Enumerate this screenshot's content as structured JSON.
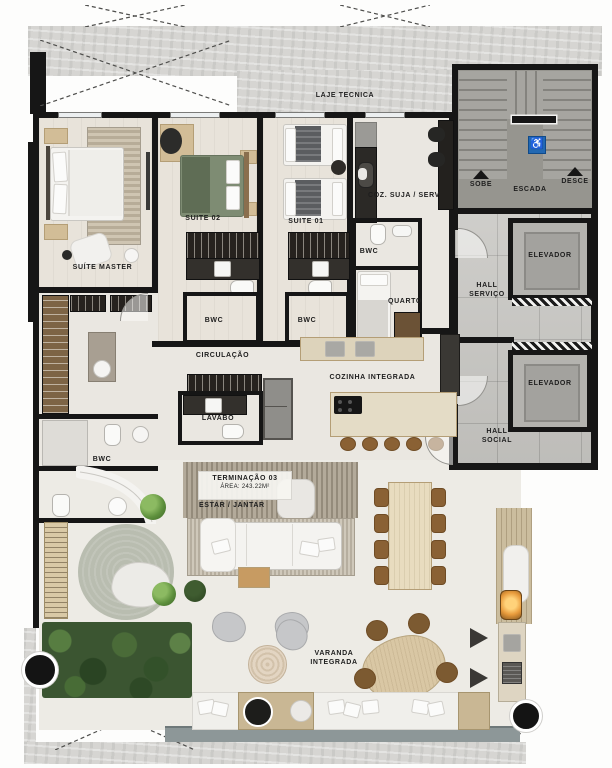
{
  "meta": {
    "title_block": {
      "unit": "TERMINAÇÃO 03",
      "area": "ÁREA: 243.22M²",
      "living_label": "ESTAR / JANTAR"
    }
  },
  "rooms": {
    "laje_tecnica": "LAJE TECNICA",
    "suite_master": "SUÍTE MASTER",
    "suite_02": "SUITE 02",
    "suite_01": "SUITE 01",
    "coz_suja": "COZ. SUJA / SERV",
    "bwc": "BWC",
    "quarto": "QUARTO",
    "circulacao": "CIRCULAÇÃO",
    "lavabo": "LAVABO",
    "cozinha_integrada": "COZINHA INTEGRADA",
    "hall_servico": "HALL\nSERVIÇO",
    "hall_social": "HALL\nSOCIAL",
    "elevador": "ELEVADOR",
    "varanda": "VARANDA\nINTEGRADA"
  },
  "stairs": {
    "sobe": "SOBE",
    "escada": "ESCADA",
    "desce": "DESCE"
  },
  "icons": {
    "accessible": "♿"
  },
  "colors": {
    "wall": "#161616",
    "floor": "#eae7e1",
    "concrete": "#d6d5d2",
    "stair_gray": "#96958f",
    "accessible_blue": "#2268b2",
    "bed_green": "#7e8c73",
    "garden_green": "#3b5531",
    "wood": "#d2bd97",
    "chair_brown": "#8a6134"
  }
}
